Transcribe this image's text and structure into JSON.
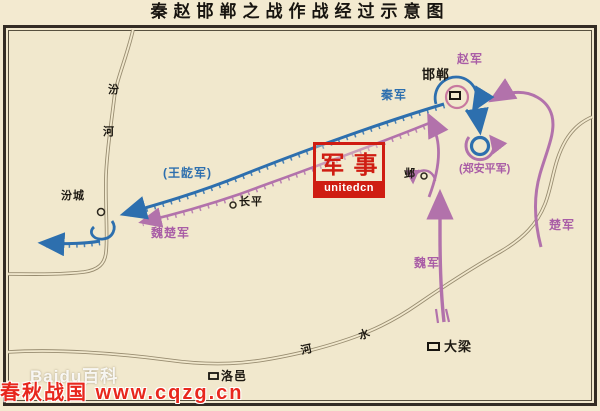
{
  "title": "秦赵邯郸之战作战经过示意图",
  "colors": {
    "qin_blue": "#2d6fae",
    "ally_purple": "#b272ab",
    "zhao_pink": "#c8799f",
    "river": "#9a8e72",
    "background": "#f1e8cd",
    "frame": "#332c24",
    "watermark_red": "#cf1d12"
  },
  "map_labels": {
    "handan": "邯郸",
    "ye": "邺",
    "changping": "长平",
    "fencheng": "汾城",
    "daliang": "大梁",
    "luoyi": "洛邑",
    "zhao_army": "赵军",
    "qin_army": "秦军",
    "wanghe_army": "(王龁军)",
    "weichu_army": "魏楚军",
    "zhenganping_army": "(郑安平军)",
    "wei_army": "魏军",
    "chu_army": "楚军",
    "fen_river_char1": "汾",
    "fen_river_char2": "河",
    "he_river_char1": "河",
    "he_river_char2": "水"
  },
  "watermarks": {
    "military_seal_char1": "军",
    "military_seal_char2": "事",
    "military_domain": "unitedcn",
    "baidu": "Baidu百科",
    "cqzg": "春秋战国 www.cqzg.cn"
  }
}
